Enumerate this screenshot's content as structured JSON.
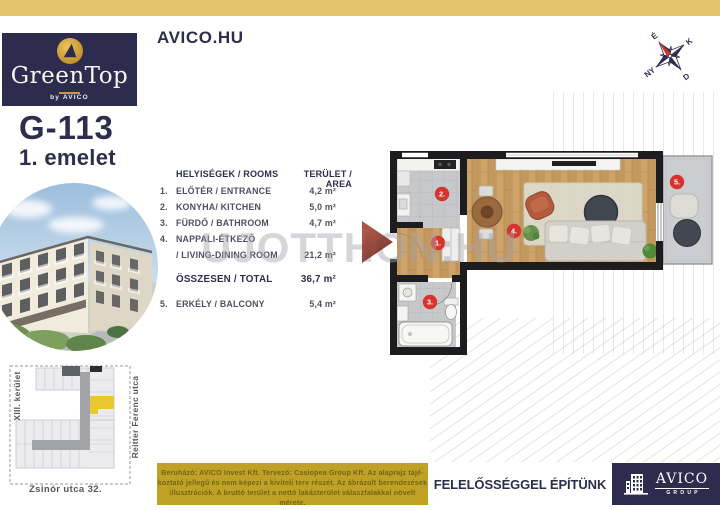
{
  "top": {
    "site": "AVICO.HU",
    "brand_name": "GreenTop",
    "brand_sub": "by AVICO"
  },
  "unit": {
    "id": "G-113",
    "floor": "1. emelet"
  },
  "table": {
    "header_rooms": "HELYISÉGEK / ROOMS",
    "header_area": "TERÜLET / AREA",
    "rows": [
      {
        "num": "1.",
        "name": "ELŐTÉR / ENTRANCE",
        "area": "4,2 m²"
      },
      {
        "num": "2.",
        "name": "KONYHA/ KITCHEN",
        "area": "5,0 m²"
      },
      {
        "num": "3.",
        "name": "FÜRDŐ / BATHROOM",
        "area": "4,7 m²"
      },
      {
        "num": "4.",
        "name": "NAPPALI-ÉTKEZŐ",
        "area": ""
      },
      {
        "num": "",
        "name": "/ LIVING-DINING ROOM",
        "area": "21,2 m²"
      },
      {
        "num": "",
        "name": "ÖSSZESEN / TOTAL",
        "area": "36,7 m²"
      },
      {
        "num": "5.",
        "name": "ERKÉLY / BALCONY",
        "area": "5,4 m²"
      }
    ]
  },
  "plan": {
    "labels": [
      "1.",
      "2.",
      "3.",
      "4.",
      "5."
    ]
  },
  "compass": {
    "n": "É",
    "e": "K",
    "s": "D",
    "w": "NY"
  },
  "watermark": {
    "text": "UJOTTHON:HU"
  },
  "siteplan": {
    "district": "XIII. kerület",
    "street": "Reitter Ferenc utca",
    "address": "Zsinór utca 32."
  },
  "footer": {
    "disclaimer": [
      "Beruházó: AVICO Invest Kft. Tervező: Casiopea Group Kft. Az alaprajz tájé-",
      "koztató jellegű és nem képezi a kiviteli terv részét. Az ábrázolt berendezések",
      "illusztrációk. A bruttó terület a nettó lakásterület válaszfalakkal növelt mérete."
    ],
    "slogan": "FELELŐSSÉGGEL ÉPÍTÜNK",
    "brand": "AVICO",
    "brand_sub": "GROUP"
  },
  "colors": {
    "navy": "#2d2c4e",
    "gold_top": "#e4c46c",
    "gold_bottom": "#bea125",
    "red_label": "#d7332f",
    "highlight_unit": "#e9c72f"
  }
}
